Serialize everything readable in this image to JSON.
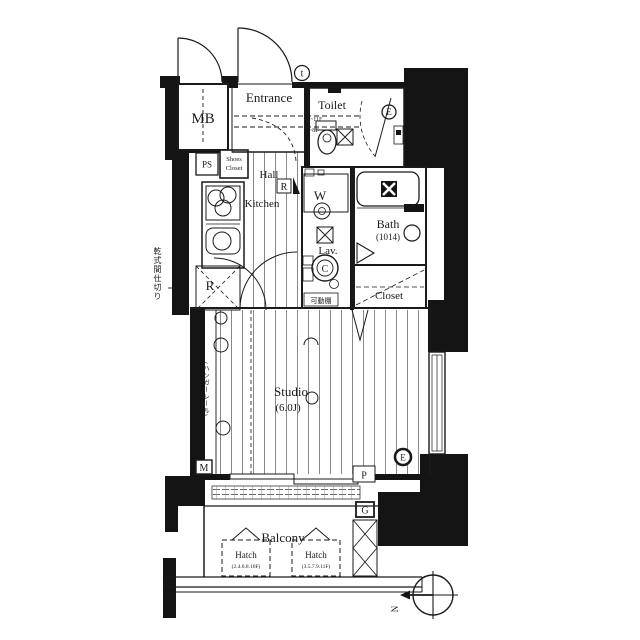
{
  "rooms": {
    "mb": "MB",
    "entrance": "Entrance",
    "toilet": "Toilet",
    "hall": "Hall",
    "kitchen": "Kitchen",
    "washer": "W",
    "lavatory": "Lav.",
    "bath": "Bath",
    "bath_size": "(1014)",
    "closet": "Closet",
    "studio": "Studio",
    "studio_size": "(6.0J)",
    "balcony": "Balcony",
    "ps": "PS",
    "shoes_closet_line1": "Shoes",
    "shoes_closet_line2": "Closet"
  },
  "markers": {
    "fridge": "R",
    "hall_r": "R",
    "door_t": "t",
    "e_toilet": "E",
    "e_studio": "E",
    "c_unit": "C",
    "gas": "G",
    "m": "M",
    "p": "P",
    "north": "N"
  },
  "annotations": {
    "movable_shelf": "可動棚",
    "dry_partition": "乾式間仕切り",
    "hanger_rail": "(ハンガーレール)",
    "floors_a": "9~11F",
    "floors_b": "2~8F",
    "hatch1_label": "Hatch",
    "hatch1_floors": "(2.4.6.8.10F)",
    "hatch2_label": "Hatch",
    "hatch2_floors": "(3.5.7.9.11F)"
  },
  "colors": {
    "ink": "#1a1a1a",
    "wall": "#141414",
    "paper": "#ffffff"
  }
}
